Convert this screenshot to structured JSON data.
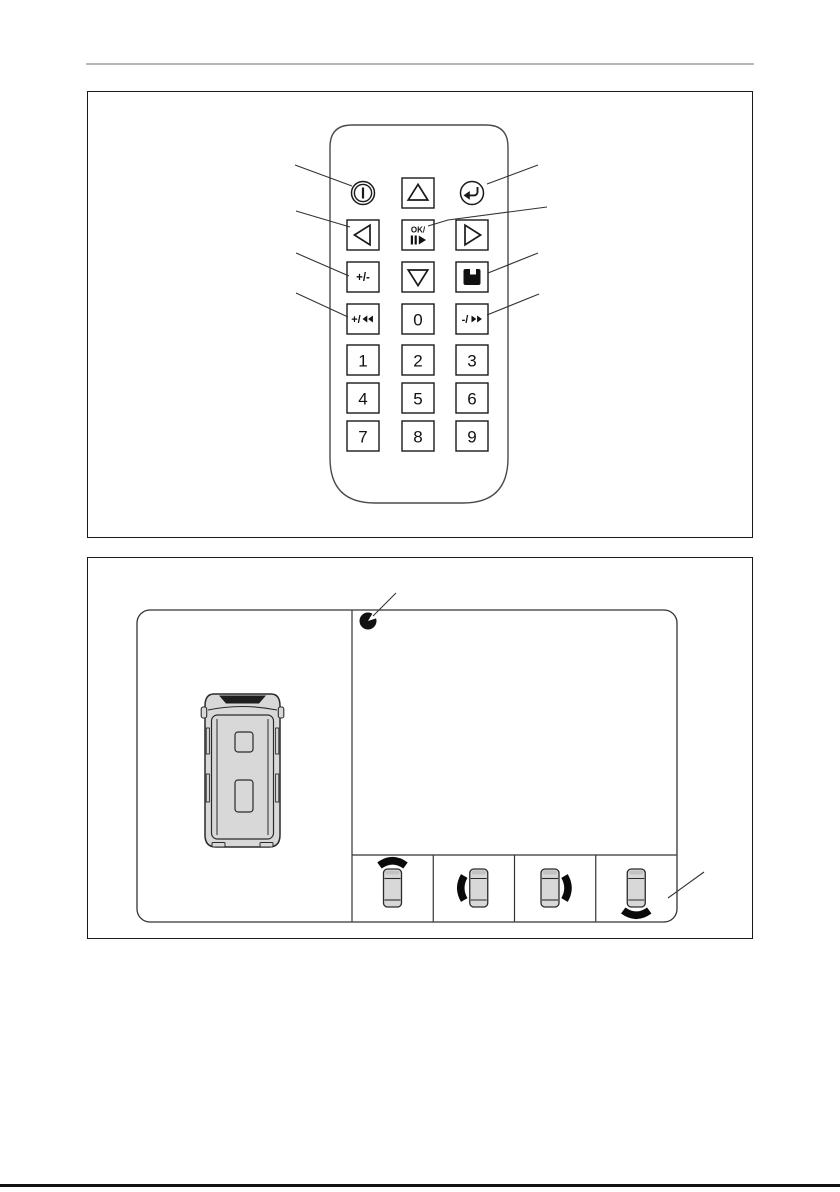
{
  "page": {
    "kind": "manual-page",
    "figures": {
      "figure1_subject": "remote-control",
      "figure2_subject": "monitor-camera-display"
    }
  },
  "colors": {
    "line": "#1a1a1a",
    "thin_line": "#333333",
    "body_outline": "#4a4a4a",
    "vehicle_fill": "#d8d8d8",
    "vehicle_stroke": "#2a2a2a",
    "icon_black": "#111111",
    "rule_top": "#b5b5b5",
    "background": "#ffffff"
  },
  "remote": {
    "name": "remote-control",
    "keys": [
      {
        "id": "power-button",
        "glyph": "power",
        "icon": "power-icon",
        "row": 0,
        "col": 0,
        "boxed": false,
        "label": ""
      },
      {
        "id": "cursor-up-button",
        "glyph": "triangle-up",
        "icon": "triangle-up-icon",
        "row": 0,
        "col": 1,
        "boxed": true,
        "label": ""
      },
      {
        "id": "enter-button",
        "glyph": "return",
        "icon": "return-arrow-icon",
        "row": 0,
        "col": 2,
        "boxed": false,
        "label": ""
      },
      {
        "id": "cursor-left-button",
        "glyph": "triangle-left",
        "icon": "triangle-left-icon",
        "row": 1,
        "col": 0,
        "boxed": true,
        "label": ""
      },
      {
        "id": "ok-play-pause-button",
        "glyph": "ok",
        "icon": "play-pause-icon",
        "row": 1,
        "col": 1,
        "boxed": true,
        "label": "OK/"
      },
      {
        "id": "cursor-right-button",
        "glyph": "triangle-right",
        "icon": "triangle-right-icon",
        "row": 1,
        "col": 2,
        "boxed": true,
        "label": ""
      },
      {
        "id": "plus-minus-button",
        "glyph": "text",
        "row": 2,
        "col": 0,
        "boxed": true,
        "label": "+/-"
      },
      {
        "id": "cursor-down-button",
        "glyph": "triangle-down",
        "icon": "triangle-down-icon",
        "row": 2,
        "col": 1,
        "boxed": true,
        "label": ""
      },
      {
        "id": "save-button",
        "glyph": "floppy",
        "icon": "floppy-disk-icon",
        "row": 2,
        "col": 2,
        "boxed": true,
        "label": ""
      },
      {
        "id": "plus-rewind-button",
        "glyph": "rewind",
        "icon": "rewind-icon",
        "row": 3,
        "col": 0,
        "boxed": true,
        "label": "+/"
      },
      {
        "id": "digit-0-button",
        "glyph": "text",
        "row": 3,
        "col": 1,
        "boxed": true,
        "label": "0"
      },
      {
        "id": "minus-forward-button",
        "glyph": "forward",
        "icon": "fast-forward-icon",
        "row": 3,
        "col": 2,
        "boxed": true,
        "label": "-/"
      },
      {
        "id": "digit-1-button",
        "glyph": "text",
        "row": 4,
        "col": 0,
        "boxed": true,
        "label": "1"
      },
      {
        "id": "digit-2-button",
        "glyph": "text",
        "row": 4,
        "col": 1,
        "boxed": true,
        "label": "2"
      },
      {
        "id": "digit-3-button",
        "glyph": "text",
        "row": 4,
        "col": 2,
        "boxed": true,
        "label": "3"
      },
      {
        "id": "digit-4-button",
        "glyph": "text",
        "row": 5,
        "col": 0,
        "boxed": true,
        "label": "4"
      },
      {
        "id": "digit-5-button",
        "glyph": "text",
        "row": 5,
        "col": 1,
        "boxed": true,
        "label": "5"
      },
      {
        "id": "digit-6-button",
        "glyph": "text",
        "row": 5,
        "col": 2,
        "boxed": true,
        "label": "6"
      },
      {
        "id": "digit-7-button",
        "glyph": "text",
        "row": 6,
        "col": 0,
        "boxed": true,
        "label": "7"
      },
      {
        "id": "digit-8-button",
        "glyph": "text",
        "row": 6,
        "col": 1,
        "boxed": true,
        "label": "8"
      },
      {
        "id": "digit-9-button",
        "glyph": "text",
        "row": 6,
        "col": 2,
        "boxed": true,
        "label": "9"
      }
    ]
  },
  "monitor_display": {
    "indicator_icon": "camera-position-indicator-icon",
    "vehicle_icon": "vehicle-top-view-icon",
    "camera_views": [
      {
        "id": "front-view-cell",
        "arc": "top",
        "icon": "front-camera-view-icon"
      },
      {
        "id": "left-view-cell",
        "arc": "left",
        "icon": "left-camera-view-icon"
      },
      {
        "id": "right-view-cell",
        "arc": "right",
        "icon": "right-camera-view-icon"
      },
      {
        "id": "rear-view-cell",
        "arc": "bottom",
        "icon": "rear-camera-view-icon"
      }
    ]
  }
}
